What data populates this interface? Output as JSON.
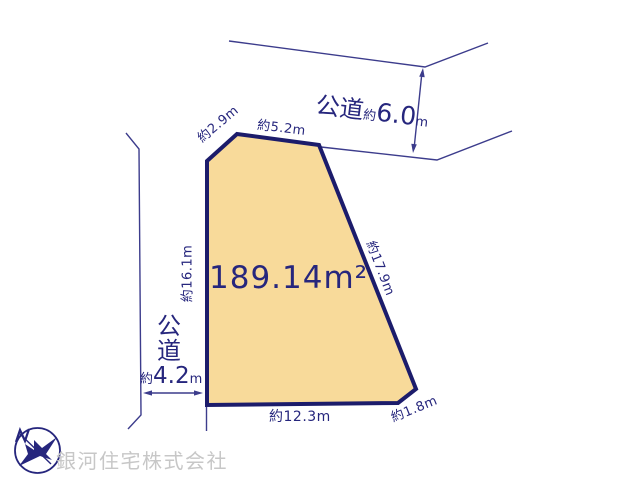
{
  "canvas": {
    "width": 640,
    "height": 480,
    "background": "#ffffff"
  },
  "colors": {
    "line_navy": "#3c3c8c",
    "text_navy": "#26267d",
    "plot_border": "#1c1c6b",
    "plot_fill": "#f8da9a",
    "watermark_gray": "#c7c7c7"
  },
  "plot": {
    "area_label": "189.14m²",
    "edge_labels": {
      "upper_left": "約2.9m",
      "top": "約5.2m",
      "right": "約17.9m",
      "left": "約16.1m",
      "bottom": "約12.3m",
      "bottom_right": "約1.8m"
    }
  },
  "top_road": {
    "name": "公道",
    "approx": "約",
    "value": "6.0",
    "unit": "m"
  },
  "left_road": {
    "name_char_1": "公",
    "name_char_2": "道",
    "approx": "約",
    "value": "4.2",
    "unit": "m"
  },
  "compass": {
    "north_label": "N"
  },
  "footer": {
    "company_name": "銀河住宅株式会社"
  }
}
